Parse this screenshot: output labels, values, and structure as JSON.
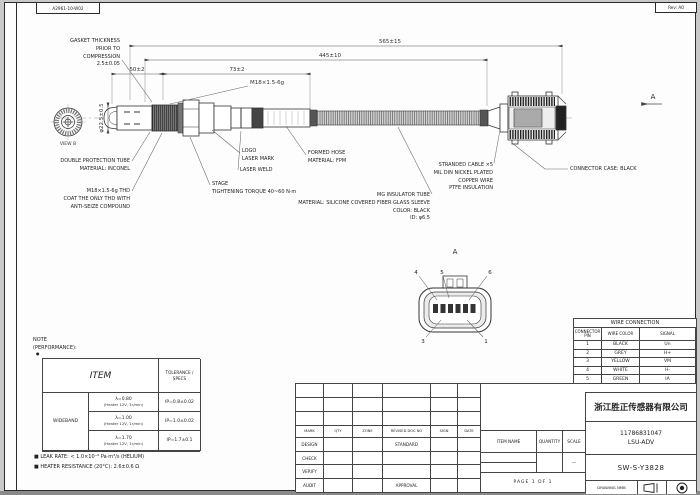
{
  "sheet": {
    "top_left_code": "A2961-10-W02",
    "rev_label": "Rev: A0"
  },
  "dimensions": {
    "overall": "565±15",
    "to_connector": "445±10",
    "dim_50": "50±2",
    "dim_73": "73±2",
    "diameter": "φ22.5±0.5",
    "thread": "M18×1.5-6g"
  },
  "labels": {
    "gasket": [
      "GASKET THICKNESS",
      "PRIOR TO",
      "COMPRESSION",
      "2.5±0.05"
    ],
    "logo": [
      "LOGO",
      "LASER MARK"
    ],
    "laser_weld": "LASER WELD",
    "torque": [
      "STAGE",
      "TIGHTENING TORQUE 40~60 N·m"
    ],
    "formed_hose": [
      "FORMED HOSE",
      "MATERIAL: FPM"
    ],
    "stranded_cable": [
      "STRANDED CABLE ×5",
      "MIL DIN NICKEL PLATED",
      "COPPER WIRE",
      "PTFE INSULATION"
    ],
    "insulator": [
      "MG INSULATOR TUBE",
      "MATERIAL: SILICONE COVERED FIBER GLASS SLEEVE",
      "COLOR: BLACK",
      "ID: φ6.5"
    ],
    "double_protection": [
      "DOUBLE PROTECTION TUBE",
      "MATERIAL: INCONEL"
    ],
    "thread_note": [
      "M18×1.5-6g THD",
      "COAT THE ONLY THD WITH",
      "ANTI-SEIZE COMPOUND"
    ],
    "connector_case": "CONNECTOR CASE: BLACK",
    "view_arrow": "A",
    "front_view_caption": "VIEW B"
  },
  "connector_view": {
    "title": "A",
    "callouts": [
      "4",
      "5",
      "6",
      "3",
      "1"
    ]
  },
  "wire_table": {
    "title": "WIRE CONNECTION",
    "col_pin": "CONNECTOR PIN",
    "col_color": "WIRE COLOR",
    "col_signal": "SIGNAL",
    "rows": [
      {
        "no": "1",
        "color": "BLACK",
        "signal": "Un"
      },
      {
        "no": "2",
        "color": "GREY",
        "signal": "H+"
      },
      {
        "no": "3",
        "color": "YELLOW",
        "signal": "VM"
      },
      {
        "no": "4",
        "color": "WHITE",
        "signal": "H-"
      },
      {
        "no": "5",
        "color": "GREEN",
        "signal": "IA"
      },
      {
        "no": "6",
        "color": "RED",
        "signal": "IP"
      }
    ]
  },
  "note": {
    "title": "NOTE",
    "subtitle": "(PERFORMANCE):",
    "bullet": "●",
    "table": {
      "item_header": "ITEM",
      "tol_header": "TOLERANCE / SPECS",
      "group": "WIDEBAND",
      "rows": [
        {
          "cond": "λ=0.80",
          "sub": "(Heater 12V, 1r/min)",
          "spec": "IP=0.8±0.02"
        },
        {
          "cond": "λ=1.00",
          "sub": "(Heater 12V, 1r/min)",
          "spec": "IP=1.0±0.02"
        },
        {
          "cond": "λ=1.70",
          "sub": "(Heater 12V, 1r/min)",
          "spec": "IP=1.7±0.1"
        }
      ]
    },
    "notes": [
      "■ LEAK RATE: < 1.0×10⁻⁶ Pa·m³/s (HELIUM)",
      "■ HEATER RESISTANCE (20°C): 2.6±0.6 Ω"
    ]
  },
  "revision_table": {
    "headers": [
      "MARK",
      "QTY",
      "ZONE",
      "REVISED DOC NO",
      "SIGN",
      "DATE"
    ],
    "rows": [
      "DESIGN",
      "CHECK",
      "VERIFY",
      "AUDIT"
    ],
    "standard": "STANDARD",
    "approval": "APPROVAL"
  },
  "title_block": {
    "company": "浙江胜正传感器有限公司",
    "part_no": "11786831047",
    "type": "LSU-ADV",
    "drawing_no": "SW-S-Y3828",
    "item_name_label": "ITEM NAME",
    "quantity_label": "QUANTITY",
    "scale_label": "SCALE",
    "scale_value": "—",
    "page": "PAGE 1 OF 1",
    "drawing_label": "DRAWING NMB"
  }
}
